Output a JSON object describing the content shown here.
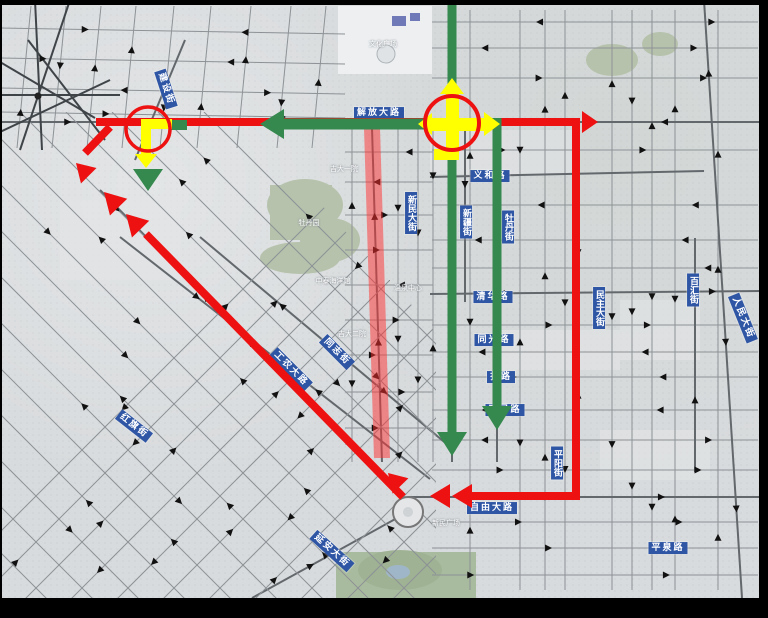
{
  "title": "traffic-detour-route-map",
  "colors": {
    "route_red": "#ee1111",
    "route_green": "#35884e",
    "signal_yellow": "#ffff00",
    "closed_band_red": "#ff3030",
    "label_blue": "#2f56a5",
    "map_background": "#d8dbdd"
  },
  "road_labels": [
    {
      "name": "jiefang-dalu",
      "text": "解放大路",
      "x": 379,
      "y": 113,
      "rot": 0,
      "vertical": false
    },
    {
      "name": "jianshe-jie",
      "text": "建设街",
      "x": 166,
      "y": 89,
      "rot": 72,
      "vertical": false
    },
    {
      "name": "yihe-lu",
      "text": "义和路",
      "x": 490,
      "y": 176,
      "rot": 0,
      "vertical": false
    },
    {
      "name": "xinmin-dajie",
      "text": "新民大街",
      "x": 411,
      "y": 213,
      "rot": 0,
      "vertical": true
    },
    {
      "name": "xinjiang-jie",
      "text": "新疆街",
      "x": 466,
      "y": 222,
      "rot": 0,
      "vertical": true
    },
    {
      "name": "mudan-jie",
      "text": "牡丹街",
      "x": 508,
      "y": 227,
      "rot": 0,
      "vertical": true
    },
    {
      "name": "minzhu-dajie",
      "text": "民主大街",
      "x": 599,
      "y": 308,
      "rot": 0,
      "vertical": true
    },
    {
      "name": "baihui-jie",
      "text": "百汇街",
      "x": 693,
      "y": 290,
      "rot": 0,
      "vertical": true
    },
    {
      "name": "renmin-dajie",
      "text": "人民大街",
      "x": 743,
      "y": 318,
      "rot": 68,
      "vertical": false
    },
    {
      "name": "qinghua-lu",
      "text": "清华路",
      "x": 493,
      "y": 297,
      "rot": 0,
      "vertical": false
    },
    {
      "name": "tongguang-lu",
      "text": "同光路",
      "x": 494,
      "y": 340,
      "rot": 0,
      "vertical": false
    },
    {
      "name": "zha-lu",
      "text": "扎路",
      "x": 501,
      "y": 377,
      "rot": 0,
      "vertical": false
    },
    {
      "name": "huimin-lu",
      "text": "惠民路",
      "x": 505,
      "y": 410,
      "rot": 0,
      "vertical": false
    },
    {
      "name": "ziyou-dalu",
      "text": "自由大路",
      "x": 492,
      "y": 508,
      "rot": 0,
      "vertical": false
    },
    {
      "name": "yanan-dajie",
      "text": "延安大街",
      "x": 332,
      "y": 551,
      "rot": 42,
      "vertical": false
    },
    {
      "name": "gongnong-dalu",
      "text": "工农大路",
      "x": 291,
      "y": 369,
      "rot": 45,
      "vertical": false
    },
    {
      "name": "tongzhi-jie",
      "text": "同志街",
      "x": 337,
      "y": 352,
      "rot": 45,
      "vertical": false
    },
    {
      "name": "hongqi-jie",
      "text": "红旗街",
      "x": 134,
      "y": 426,
      "rot": 38,
      "vertical": false
    },
    {
      "name": "pingyang-jie",
      "text": "平阳街",
      "x": 557,
      "y": 463,
      "rot": 0,
      "vertical": true
    },
    {
      "name": "pingquan-lu",
      "text": "平泉路",
      "x": 668,
      "y": 548,
      "rot": 0,
      "vertical": false
    }
  ],
  "poi_labels": [
    {
      "text": "文化广场",
      "x": 383,
      "y": 44
    },
    {
      "text": "吉大一院",
      "x": 344,
      "y": 169
    },
    {
      "text": "牡丹园",
      "x": 309,
      "y": 223
    },
    {
      "text": "中泰海洋馆",
      "x": 333,
      "y": 281
    },
    {
      "text": "温泉中心",
      "x": 408,
      "y": 288
    },
    {
      "text": "吉大二院",
      "x": 352,
      "y": 334
    },
    {
      "text": "新民广场",
      "x": 446,
      "y": 523
    }
  ],
  "icons": [
    {
      "name": "traffic-signal-west",
      "parts": [
        "red-circle-icon",
        "yellow-left-turn-arrow-icon",
        "green-straight-down-arrow-icon"
      ]
    },
    {
      "name": "traffic-signal-center",
      "parts": [
        "red-circle-icon",
        "yellow-cross-arrows-icon"
      ]
    },
    {
      "name": "one-way-arrow-icons",
      "glyph": "small black triangles on streets"
    }
  ],
  "routes": [
    {
      "name": "red-detour-loop",
      "color": "#ee1111"
    },
    {
      "name": "green-through-route",
      "color": "#35884e"
    },
    {
      "name": "closed-road-segment",
      "color": "#ff3030"
    }
  ]
}
